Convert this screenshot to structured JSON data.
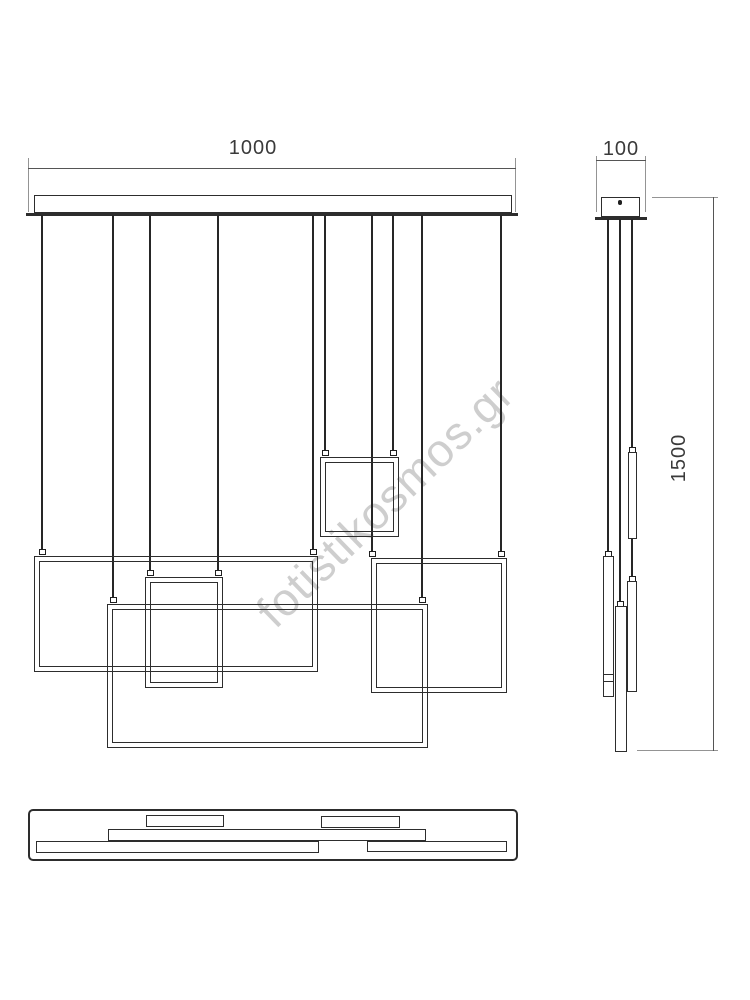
{
  "watermark": {
    "text": "fotistikosmos.gr"
  },
  "dimensions": {
    "front_width": "1000",
    "side_width": "100",
    "overall_height": "1500"
  },
  "colors": {
    "drawing_line": "#2d2d2d",
    "dimension_line": "#555555",
    "extension_line": "#949494",
    "watermark": "#c9c9c9",
    "background": "#ffffff"
  }
}
